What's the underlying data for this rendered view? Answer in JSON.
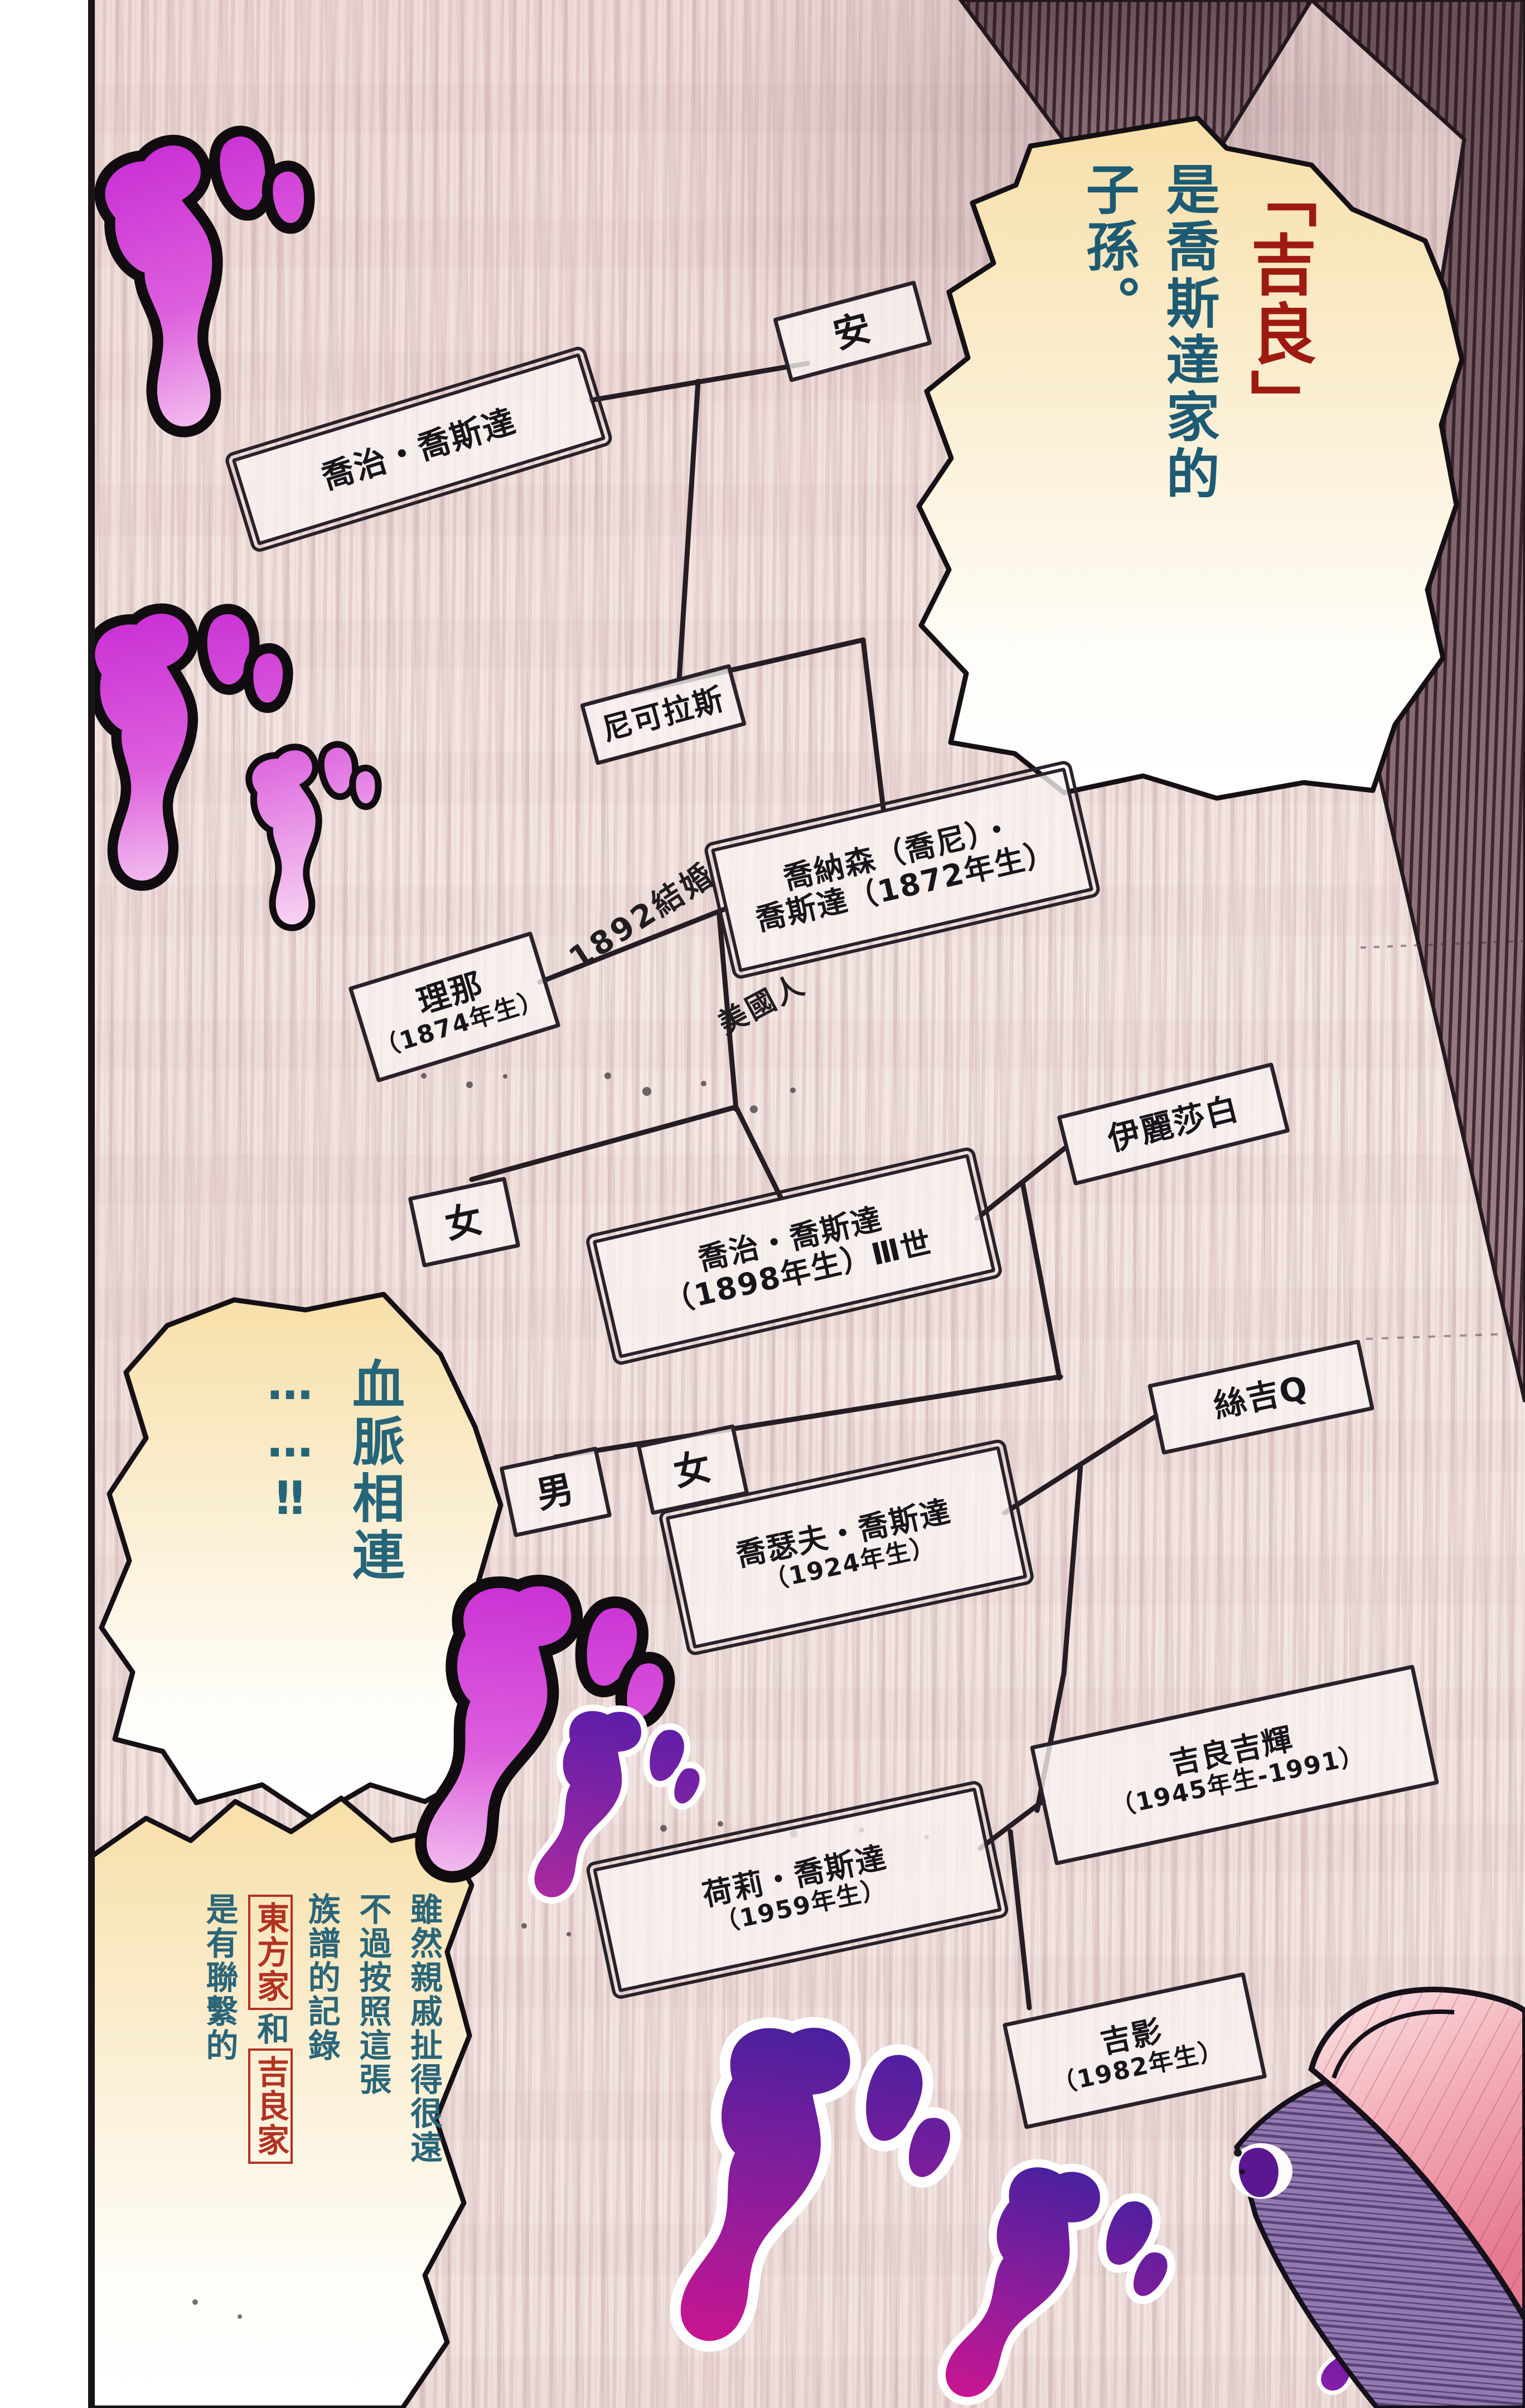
{
  "bubbles": {
    "top_right": {
      "seg1": "「吉良」",
      "seg2": "是喬斯達家的",
      "seg3": "子孫。"
    },
    "middle_left": {
      "line1": "血脈相連",
      "line2": "……‼"
    },
    "bottom_left": {
      "col1": "雖然親戚扯得很遠",
      "col2": "不過按照這張",
      "col3": "族譜的記錄",
      "col4_box1": "東方家",
      "col4_mid": "和",
      "col4_box2": "吉良家",
      "col5": "是有聯繫的"
    }
  },
  "tree": {
    "nodes": {
      "ann": {
        "line1": "安"
      },
      "george1": {
        "line1": "喬治・喬斯達"
      },
      "nicholas": {
        "line1": "尼可拉斯"
      },
      "jonathan": {
        "line1": "喬納森（喬尼）・",
        "line2": "喬斯達（1872年生）"
      },
      "rina": {
        "line1": "理那",
        "line2": "（1874年生）"
      },
      "elizabeth": {
        "line1": "伊麗莎白"
      },
      "george3": {
        "line1": "喬治・喬斯達",
        "line2": "（1898年生）Ⅲ世"
      },
      "daughter1": {
        "line1": "女"
      },
      "son": {
        "line1": "男"
      },
      "daughter2": {
        "line1": "女"
      },
      "joseph": {
        "line1": "喬瑟夫・喬斯達",
        "line2": "（1924年生）"
      },
      "suziq": {
        "line1": "絲吉Q"
      },
      "yoshiteru": {
        "line1": "吉良吉輝",
        "line2": "（1945年生-1991）"
      },
      "holly": {
        "line1": "荷莉・喬斯達",
        "line2": "（1959年生）"
      },
      "yoshikage": {
        "line1": "吉影",
        "line2": "（1982年生）"
      }
    }
  },
  "annotations": {
    "marriage_1892": "1892結婚",
    "american": "美國人"
  },
  "sfx_glyph": "ゴ",
  "colors": {
    "bubble_cream": "#f7dfa8",
    "text_teal": "#1d5a73",
    "text_red": "#9e1a10",
    "red_box": "#b23222",
    "sfx_magenta": "#d936d9",
    "sfx_purple": "#4520a8",
    "hat_pink": "#ee8fa0",
    "hat_purple": "#8b6fa8"
  }
}
